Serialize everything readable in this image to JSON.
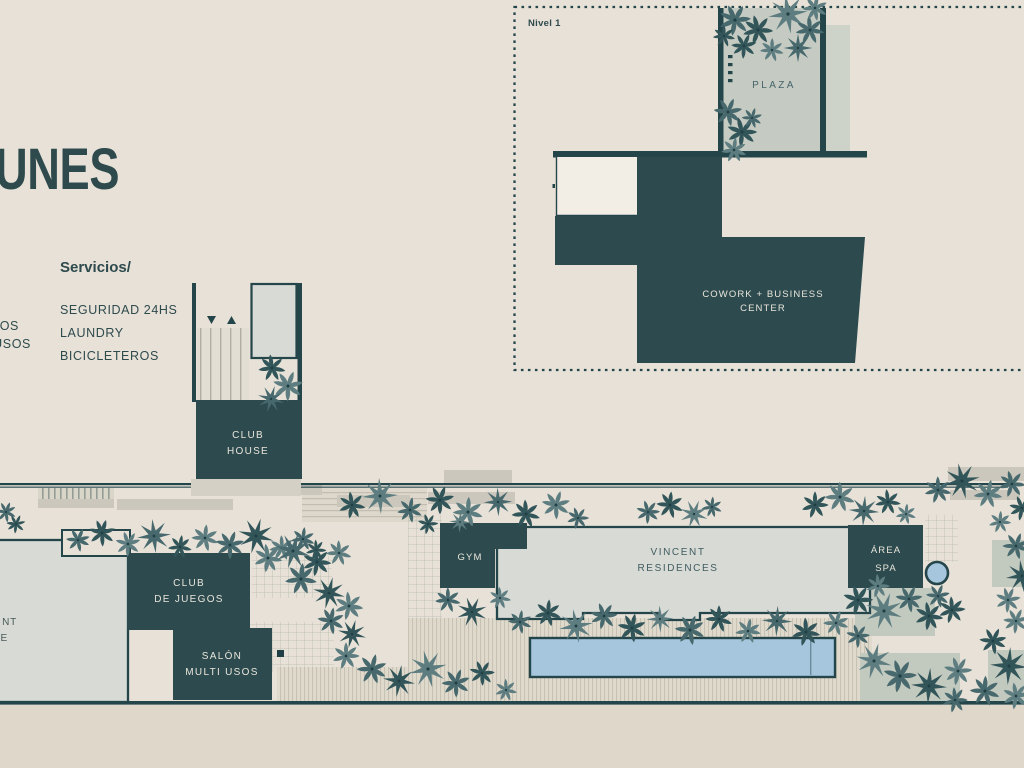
{
  "page": {
    "title_fragment": "UNES"
  },
  "services": {
    "heading": "Servicios/",
    "items": [
      "SEGURIDAD 24HS",
      "LAUNDRY",
      "BICICLETEROS"
    ]
  },
  "cut_labels": {
    "amenity_line_1": "OS",
    "amenity_line_2": "USOS",
    "left_building_line_1": "NT",
    "left_building_line_2": "E"
  },
  "inset": {
    "level_label": "Nivel 1",
    "plaza_label": "PLAZA",
    "cowork_line_1": "COWORK + BUSINESS",
    "cowork_line_2": "CENTER"
  },
  "plan": {
    "club_house": {
      "line1": "CLUB",
      "line2": "HOUSE"
    },
    "club_de_juegos": {
      "line1": "CLUB",
      "line2": "DE JUEGOS"
    },
    "salon_multiusos": {
      "line1": "SALÓN",
      "line2": "MULTI USOS"
    },
    "gym": {
      "line1": "GYM"
    },
    "residences": {
      "line1": "VINCENT",
      "line2": "RESIDENCES"
    },
    "area_spa": {
      "line1": "ÁREA",
      "line2": "SPA"
    }
  },
  "palette": {
    "background": "#e7e1d7",
    "lower_band": "#ded7ca",
    "dark_teal_block": "#2d4b4f",
    "outline_dark": "#24454a",
    "light_building": "#d8dad5",
    "plaza_green": "#c5cbc2",
    "pool_blue": "#a6c6de",
    "sidewalk_gray": "#cbc7bc",
    "label_light": "#e9e5da",
    "text_dark": "#2e4a4d"
  }
}
